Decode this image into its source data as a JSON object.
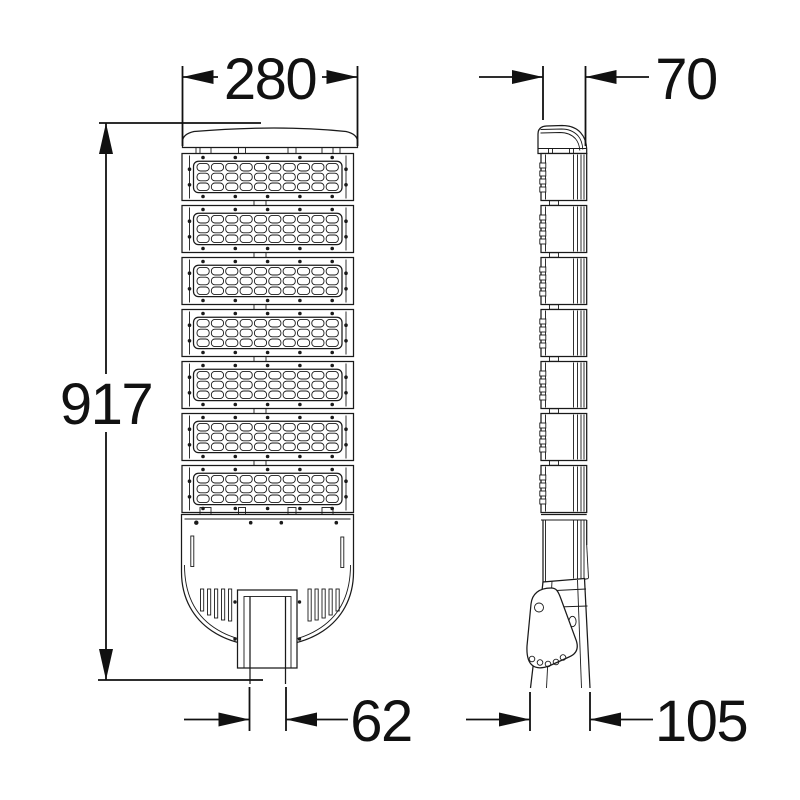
{
  "drawing": {
    "type": "technical-dimension-drawing",
    "subject": "LED street light - front and side views",
    "background": "#ffffff",
    "line_color": "#1a1a1a",
    "dimension_color": "#111111",
    "dimensions": {
      "width": "280",
      "depth": "70",
      "height": "917",
      "pole_width_front": "62",
      "pole_depth_side": "105"
    },
    "front_view": {
      "module_count": 7,
      "lens_rows": 3,
      "lens_cols": 10,
      "screws_per_edge": 5,
      "vent_slots_per_side": 5
    },
    "side_view": {
      "segment_count": 7,
      "clips_per_segment": 4,
      "fin_line_count": 4,
      "bracket_top_holes": 1,
      "bracket_arc_holes": 5
    }
  }
}
